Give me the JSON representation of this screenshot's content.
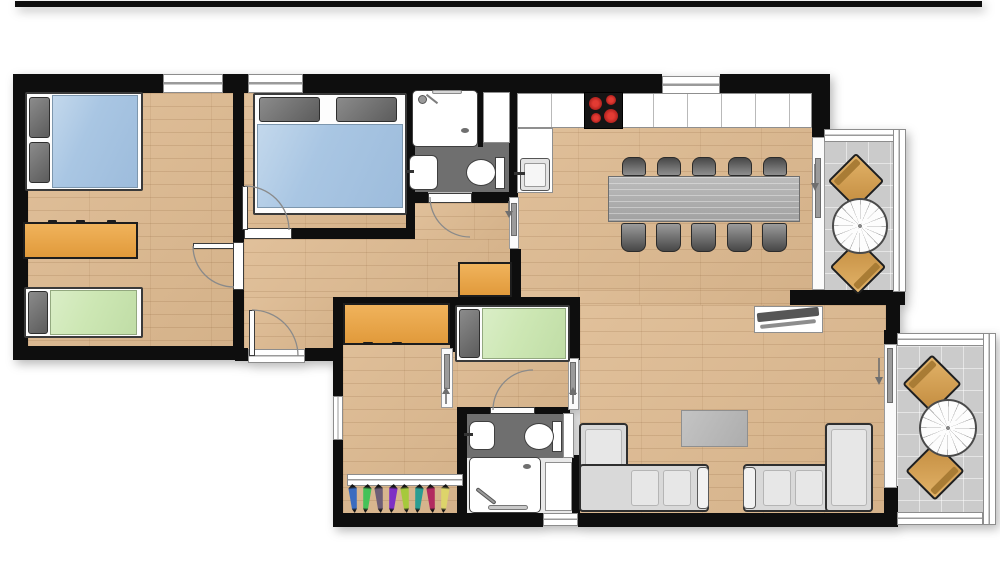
{
  "scene": {
    "title": "Apartment floor plan (top-down)",
    "type": "floor-plan",
    "text_content": "none visible",
    "units_note": "single large apartment with connected studio room"
  },
  "palette": {
    "wall": "#0e0e0e",
    "wood_floor": "#ddb98f",
    "bathroom_floor": "#6f6f6f",
    "balcony_tile": "#cbcbcb",
    "mattress_blue": "#a9c6e3",
    "mattress_green": "#cde7b4",
    "furniture_orange": "#e9a94e",
    "pillow_gray": "#6f6f6f",
    "dining_table_gray": "#b3b3b3",
    "chair_gray": "#5f5f5f",
    "sofa_gray": "#d9d9d9",
    "balcony_chair_tan": "#d2a05c",
    "cooktop_black": "#151515",
    "burner_red": "#c4191d"
  },
  "counts": {
    "bedrooms": 3,
    "beds_double": 2,
    "beds_single": 2,
    "bathrooms": 2,
    "balconies": 2,
    "dining_chairs": 10,
    "balcony_chairs_per_balcony": 2,
    "skis_in_rack": 8
  },
  "rooms": [
    {
      "id": "bedroom-1",
      "name": "Bedroom 1 (left)",
      "furniture": [
        "double-bed-blue with 2 gray pillows",
        "orange desk/sideboard",
        "single-bed-green"
      ],
      "windows": [
        "top-wall window"
      ],
      "doors": [
        "hinged door to hallway"
      ]
    },
    {
      "id": "bedroom-2",
      "name": "Bedroom 2 (top middle)",
      "furniture": [
        "double-bed-blue with 2 gray pillows"
      ],
      "windows": [
        "top-wall window"
      ],
      "doors": [
        "hinged door to hallway"
      ]
    },
    {
      "id": "bathroom-1",
      "name": "Bathroom 1 (top)",
      "fixtures": [
        "shower tray with shower head",
        "white cabinet",
        "washbasin",
        "toilet"
      ],
      "floor": "dark gray",
      "doors": [
        "hinged door to hallway"
      ]
    },
    {
      "id": "hallway",
      "name": "Hallway",
      "features": [
        "apartment entrance door (bottom)",
        "orange sideboard",
        "sliding door to kitchen/living"
      ]
    },
    {
      "id": "kitchen-dining",
      "name": "Kitchen / dining",
      "furniture": [
        "kitchen counter (top run)",
        "cooktop with 4 red burners",
        "kitchen sink (left run)",
        "long gray dining table",
        "10 gray chairs (5 + 5)"
      ],
      "windows": [
        "top-wall window"
      ],
      "doors": [
        "sliding door to upper balcony"
      ]
    },
    {
      "id": "living-room",
      "name": "Living room",
      "furniture": [
        "L-shaped sofa left",
        "L-shaped sofa right",
        "gray coffee table",
        "TV sideboard"
      ],
      "doors": [
        "sliding door to lower balcony"
      ]
    },
    {
      "id": "studio-room",
      "name": "Studio room (bottom middle)",
      "furniture": [
        "orange wardrobe/desk",
        "single-bed-green with gray pillow",
        "ski rack"
      ],
      "windows": [
        "left-wall window"
      ],
      "doors": [
        "sliding door to corridor",
        "sliding door to living room",
        "sliding door to ski storage"
      ]
    },
    {
      "id": "bathroom-2",
      "name": "Bathroom 2 (bottom)",
      "fixtures": [
        "washbasin",
        "toilet",
        "shower tray with hand shower",
        "white cabinet"
      ],
      "floor": "dark gray",
      "windows": [
        "bottom-wall window"
      ],
      "doors": [
        "hinged door to studio room"
      ]
    },
    {
      "id": "balcony-upper",
      "name": "Balcony (top right)",
      "furniture": [
        "round bistro table",
        "2 wooden chairs (diagonal)"
      ],
      "floor": "gray tile"
    },
    {
      "id": "balcony-lower",
      "name": "Balcony (bottom right)",
      "furniture": [
        "round bistro table",
        "2 wooden chairs (diagonal)"
      ],
      "floor": "gray tile"
    }
  ],
  "ski_storage": {
    "count": 8,
    "colors": [
      "#3b6cc0",
      "#45c258",
      "#6e5e76",
      "#7e2fc4",
      "#a6c93c",
      "#2a9d92",
      "#b22960",
      "#ddd46a"
    ]
  },
  "door_symbols": {
    "hinged": 5,
    "sliding": 7,
    "direction_arrows": 5
  }
}
